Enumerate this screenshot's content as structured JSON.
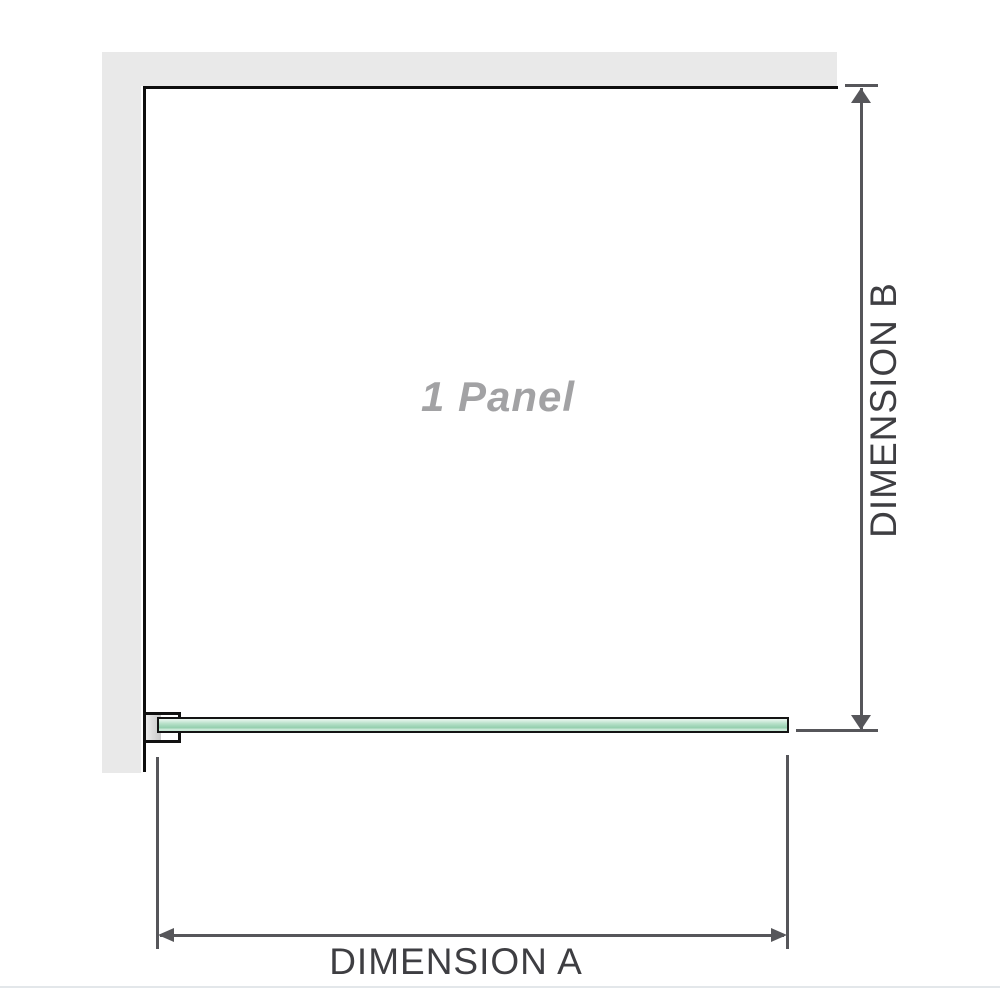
{
  "diagram": {
    "title": "1 Panel",
    "dimension_a_label": "DIMENSION A",
    "dimension_b_label": "DIMENSION B"
  },
  "icons": {
    "arrow_up": "dimension-b upper arrowhead",
    "arrow_down": "dimension-b lower arrowhead",
    "arrow_left": "dimension-a left arrowhead",
    "arrow_right": "dimension-a right arrowhead"
  },
  "colors": {
    "wall": "#e9e9e9",
    "panel_outline": "#0e0e0e",
    "dimension_line": "#56565a",
    "dimension_text": "#3e3e42",
    "panel_label_text": "#a2a2a4",
    "glass_light": "#ecf7f1",
    "glass_mid": "#94cfae",
    "bracket_shade": "#c7c7c7",
    "bottom_divider": "#e3e7ea"
  }
}
